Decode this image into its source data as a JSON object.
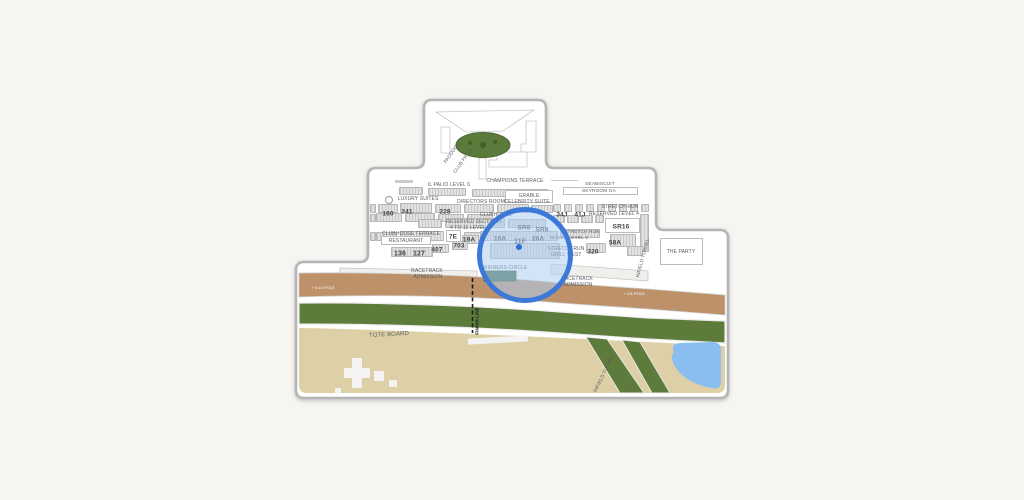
{
  "page": {
    "background": "#f7f5f2"
  },
  "map": {
    "title": "racetrack-seating-map",
    "colors": {
      "white": "#ffffff",
      "outline": "#b5b5b5",
      "inner_line": "#c6c6c6",
      "dirt": "#bd9169",
      "turf": "#5d7b3b",
      "infield": "#ddd0a6",
      "pond": "#8abdf0",
      "paddock_green": "#5c7a39",
      "paddock_dot": "#42602a",
      "structure_white": "#f4f3f1",
      "winners_green": "#3f6e47",
      "walkway": "#f0efec",
      "label": "#5a5e63",
      "number": "#3f4449",
      "finish": "#1c1c1c",
      "track_text": "#ffffff"
    },
    "magnifier": {
      "cx": 525,
      "cy": 255,
      "r": 48,
      "stroke": "#3b78d8",
      "stroke_width": 5,
      "tint": "rgba(173,205,242,0.55)",
      "dot": {
        "x": 519,
        "y": 247,
        "r": 3,
        "color": "#2b6fd4"
      }
    },
    "labels": [
      {
        "id": "il-palio-level-6",
        "text": "IL PALIO LEVEL 6",
        "x": 449,
        "y": 184.5,
        "s": 5,
        "c": "lbl"
      },
      {
        "id": "champions-terrace",
        "text": "CHAMPIONS TERRACE",
        "x": 515,
        "y": 180.5,
        "s": 5,
        "c": "lbl"
      },
      {
        "id": "seabiscuit",
        "text": "SEABISCUIT",
        "x": 600,
        "y": 184,
        "s": 4.8,
        "c": "lbl"
      },
      {
        "id": "skyroom-ga",
        "text": "SKYROOM GA",
        "x": 599,
        "y": 190.5,
        "s": 4.8,
        "c": "lbl"
      },
      {
        "id": "luxury-suites",
        "text": "LUXURY SUITES",
        "x": 418,
        "y": 198.5,
        "s": 5,
        "c": "lbl"
      },
      {
        "id": "directors-room",
        "text": "DIRECTORS ROOM",
        "x": 481,
        "y": 201.5,
        "s": 5,
        "c": "lbl"
      },
      {
        "id": "grable",
        "text": "GRABLE",
        "x": 529,
        "y": 195.5,
        "s": 5,
        "c": "lbl"
      },
      {
        "id": "celebrity-suite",
        "text": "CELEBRITY SUITE",
        "x": 527,
        "y": 201.5,
        "s": 5,
        "c": "lbl"
      },
      {
        "id": "stretch-run-level4",
        "text": "STRETCH RUN",
        "x": 620,
        "y": 206.5,
        "s": 5,
        "c": "lbl"
      },
      {
        "id": "reserved-level-4",
        "text": "RESERVED LEVEL 4",
        "x": 614,
        "y": 213.5,
        "s": 5,
        "c": "lbl"
      },
      {
        "id": "sec-160",
        "text": "160",
        "x": 388,
        "y": 212.5,
        "s": 6.5,
        "c": "num"
      },
      {
        "id": "sec-241",
        "text": "241",
        "x": 407,
        "y": 210.5,
        "s": 6.5,
        "c": "num"
      },
      {
        "id": "sec-228",
        "text": "228",
        "x": 445,
        "y": 211,
        "s": 6.5,
        "c": "num"
      },
      {
        "id": "clubhouse",
        "text": "CLUBHOUSE",
        "x": 496,
        "y": 214.5,
        "s": 5,
        "c": "lbl"
      },
      {
        "id": "sec-34j",
        "text": "34J",
        "x": 562,
        "y": 213.5,
        "s": 6.5,
        "c": "num"
      },
      {
        "id": "sec-41j",
        "text": "41J",
        "x": 580,
        "y": 213.5,
        "s": 6.5,
        "c": "num"
      },
      {
        "id": "reserved-sections",
        "text": "RESERVED SECTIONS",
        "x": 474,
        "y": 221.5,
        "s": 5,
        "c": "lbl"
      },
      {
        "id": "four-to-11-level-3",
        "text": "4 TO 11 LEVEL 3",
        "x": 470,
        "y": 227.5,
        "s": 5,
        "c": "lbl"
      },
      {
        "id": "sec-sr6",
        "text": "SR6",
        "x": 524,
        "y": 227,
        "s": 6.5,
        "c": "num"
      },
      {
        "id": "sec-sr8",
        "text": "SR8",
        "x": 542,
        "y": 229,
        "s": 6.5,
        "c": "num"
      },
      {
        "id": "stretch-run-sr",
        "text": "STRETCH RUN",
        "x": 582,
        "y": 231.5,
        "s": 4.8,
        "c": "lbl"
      },
      {
        "id": "sec-sr16",
        "text": "SR16",
        "x": 621,
        "y": 226,
        "s": 6.5,
        "c": "num"
      },
      {
        "id": "clubhouse-terrace",
        "text": "CLUBHOUSE TERRACE",
        "x": 411,
        "y": 233.5,
        "s": 5,
        "c": "lbl"
      },
      {
        "id": "sec-7e",
        "text": "7E",
        "x": 453,
        "y": 235.5,
        "s": 6.5,
        "c": "num"
      },
      {
        "id": "boxes-level-2",
        "text": "BOXES LEVEL 2",
        "x": 569,
        "y": 238,
        "s": 4.8,
        "c": "lbl"
      },
      {
        "id": "sec-58a",
        "text": "58A",
        "x": 615,
        "y": 241.5,
        "s": 6.5,
        "c": "num"
      },
      {
        "id": "restaurant",
        "text": "RESTAURANT",
        "x": 406,
        "y": 240.5,
        "s": 5,
        "c": "lbl"
      },
      {
        "id": "sec-19a",
        "text": "19A",
        "x": 469,
        "y": 238.5,
        "s": 6.5,
        "c": "num"
      },
      {
        "id": "sec-10a",
        "text": "10A",
        "x": 500,
        "y": 237.5,
        "s": 6.5,
        "c": "num"
      },
      {
        "id": "sec-11f",
        "text": "11F",
        "x": 520,
        "y": 241,
        "s": 7,
        "c": "num"
      },
      {
        "id": "sec-26a",
        "text": "26A",
        "x": 538,
        "y": 238,
        "s": 6.5,
        "c": "num"
      },
      {
        "id": "sec-703",
        "text": "703",
        "x": 459,
        "y": 245,
        "s": 6.5,
        "c": "num"
      },
      {
        "id": "sec-407",
        "text": "407",
        "x": 437,
        "y": 248.5,
        "s": 6.5,
        "c": "num"
      },
      {
        "id": "sec-136",
        "text": "136",
        "x": 400,
        "y": 253,
        "s": 7,
        "c": "num"
      },
      {
        "id": "sec-127",
        "text": "127",
        "x": 419,
        "y": 253,
        "s": 7,
        "c": "num"
      },
      {
        "id": "stretch-run-grill",
        "text": "STRETCH RUN",
        "x": 566,
        "y": 248.5,
        "s": 5,
        "c": "lbl"
      },
      {
        "id": "grill-west",
        "text": "GRILL WEST",
        "x": 566,
        "y": 254.5,
        "s": 5,
        "c": "lbl"
      },
      {
        "id": "sec-320",
        "text": "320",
        "x": 593,
        "y": 250.5,
        "s": 6.5,
        "c": "num"
      },
      {
        "id": "racetrack-adm-left-1",
        "text": "RACETRACK",
        "x": 427,
        "y": 270.5,
        "s": 5,
        "c": "lbl"
      },
      {
        "id": "racetrack-adm-left-2",
        "text": "ADMISSION",
        "x": 428,
        "y": 277,
        "s": 5,
        "c": "lbl"
      },
      {
        "id": "winners-circle",
        "text": "WINNERS CIRCLE",
        "x": 505,
        "y": 267.5,
        "s": 5,
        "c": "lbl"
      },
      {
        "id": "racetrack-adm-right-1",
        "text": "RACETRACK",
        "x": 577,
        "y": 278.5,
        "s": 5,
        "c": "lbl"
      },
      {
        "id": "racetrack-adm-right-2",
        "text": "ADMISSION",
        "x": 578,
        "y": 284.5,
        "s": 5,
        "c": "lbl"
      },
      {
        "id": "the-party",
        "text": "THE PARTY",
        "x": 681,
        "y": 252,
        "s": 5,
        "c": "lbl"
      },
      {
        "id": "infield-tunnel-upper",
        "text": "INFIELD TUNNEL",
        "x": 643,
        "y": 258,
        "s": 4.8,
        "c": "lbl",
        "r": -75
      },
      {
        "id": "paddock",
        "text": "PADDOCK",
        "x": 452,
        "y": 153,
        "s": 4.8,
        "c": "lbl",
        "r": -55
      },
      {
        "id": "club-patio",
        "text": "CLUB PATIO",
        "x": 463,
        "y": 161,
        "s": 4.8,
        "c": "lbl",
        "r": -55
      },
      {
        "id": "tote-board",
        "text": "TOTE BOARD",
        "x": 389,
        "y": 333.5,
        "s": 6,
        "c": "lbl",
        "r": -3
      },
      {
        "id": "finish-line",
        "text": "FINISH LINE",
        "x": 477,
        "y": 321,
        "s": 4.5,
        "c": "dark",
        "r": -90
      },
      {
        "id": "pole-left",
        "text": "+ 1/16 POLE",
        "x": 323,
        "y": 287.5,
        "s": 4,
        "c": "white"
      },
      {
        "id": "pole-right",
        "text": "+ 1/8 POLE",
        "x": 634,
        "y": 294,
        "s": 4,
        "c": "white"
      },
      {
        "id": "infield-tunnel-lower",
        "text": "INFIELD TUNNEL",
        "x": 604,
        "y": 374,
        "s": 4.8,
        "c": "lbl",
        "r": -64
      }
    ],
    "blocks": [
      [
        399,
        187,
        24,
        8
      ],
      [
        428,
        188,
        38,
        8
      ],
      [
        472,
        189,
        76,
        8
      ],
      [
        370,
        204,
        6,
        9
      ],
      [
        378,
        204,
        20,
        9
      ],
      [
        400,
        203,
        32,
        10
      ],
      [
        435,
        204,
        26,
        9
      ],
      [
        464,
        204,
        30,
        9
      ],
      [
        497,
        204,
        32,
        9
      ],
      [
        531,
        205,
        22,
        8
      ],
      [
        553,
        204,
        8,
        8
      ],
      [
        564,
        204,
        8,
        8
      ],
      [
        575,
        204,
        8,
        8
      ],
      [
        586,
        204,
        8,
        8
      ],
      [
        597,
        204,
        8,
        8
      ],
      [
        608,
        204,
        8,
        8
      ],
      [
        619,
        204,
        8,
        8
      ],
      [
        630,
        204,
        8,
        8
      ],
      [
        641,
        204,
        8,
        8
      ],
      [
        370,
        214,
        6,
        8
      ],
      [
        376,
        213,
        26,
        9
      ],
      [
        405,
        213,
        30,
        9
      ],
      [
        438,
        214,
        26,
        8
      ],
      [
        467,
        214,
        26,
        8
      ],
      [
        553,
        215,
        12,
        8
      ],
      [
        567,
        215,
        12,
        8
      ],
      [
        581,
        215,
        12,
        8
      ],
      [
        595,
        215,
        9,
        8
      ],
      [
        418,
        219,
        24,
        9
      ],
      [
        445,
        218,
        60,
        10
      ],
      [
        508,
        219,
        38,
        9
      ],
      [
        640,
        214,
        9,
        38
      ],
      [
        370,
        232,
        6,
        9
      ],
      [
        376,
        232,
        21,
        9
      ],
      [
        400,
        231,
        44,
        10
      ],
      [
        464,
        232,
        28,
        9
      ],
      [
        480,
        231,
        78,
        10
      ],
      [
        560,
        229,
        40,
        9
      ],
      [
        610,
        234,
        26,
        13
      ],
      [
        462,
        235,
        17,
        9
      ],
      [
        452,
        241,
        16,
        9
      ],
      [
        432,
        244,
        17,
        9
      ],
      [
        391,
        247,
        42,
        10
      ],
      [
        490,
        243,
        70,
        16
      ],
      [
        586,
        243,
        20,
        10
      ],
      [
        627,
        246,
        16,
        10
      ]
    ],
    "boxes": [
      {
        "x": 563,
        "y": 187,
        "w": 75,
        "h": 8,
        "t": "outline",
        "name": "skyroom-box"
      },
      {
        "x": 505,
        "y": 190,
        "w": 48,
        "h": 13,
        "t": "outline",
        "name": "grable-suite-box"
      },
      {
        "x": 605,
        "y": 218,
        "w": 35,
        "h": 15,
        "t": "outline",
        "name": "sr16-box"
      },
      {
        "x": 446,
        "y": 230,
        "w": 15,
        "h": 12,
        "t": "outline",
        "name": "7e-box"
      },
      {
        "x": 381,
        "y": 236,
        "w": 50,
        "h": 9,
        "t": "outline",
        "name": "restaurant-box"
      },
      {
        "x": 660,
        "y": 238,
        "w": 43,
        "h": 27,
        "t": "outline",
        "name": "the-party-box"
      },
      {
        "x": 395,
        "y": 180,
        "w": 18,
        "h": 2.5,
        "t": "fill",
        "name": "deck-dash"
      },
      {
        "x": 551,
        "y": 180,
        "w": 27,
        "h": 1.2,
        "t": "fill",
        "name": "terrace-line"
      },
      {
        "x": 385,
        "y": 196,
        "w": 8,
        "h": 8,
        "t": "ring",
        "name": "o-marker"
      }
    ]
  }
}
